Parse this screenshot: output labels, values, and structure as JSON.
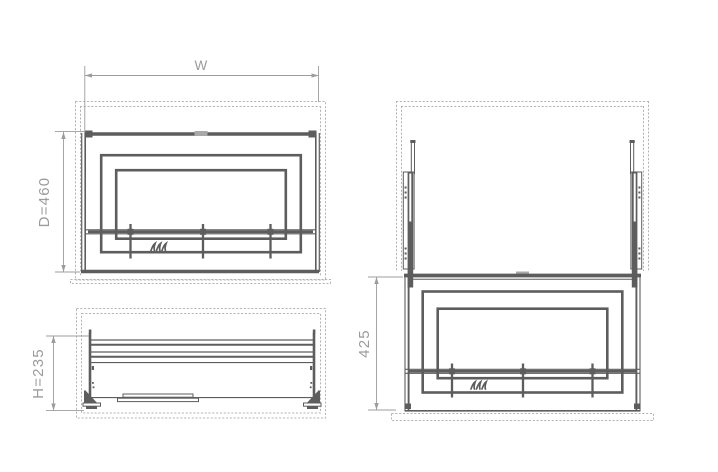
{
  "dimensions": {
    "width": "W",
    "depth": "D=460",
    "height": "H=235",
    "extension": "425"
  },
  "icons": {
    "hanger_hooks": "hanger-hooks-icon"
  },
  "colors": {
    "background": "#ffffff",
    "cabinet_outline": "#b4b4b4",
    "cabinet_light": "#a9a9a9",
    "mechanism": "#5d5d5d",
    "dimension_line": "#9c9c9c",
    "dimension_text": "#9b9b9b"
  }
}
